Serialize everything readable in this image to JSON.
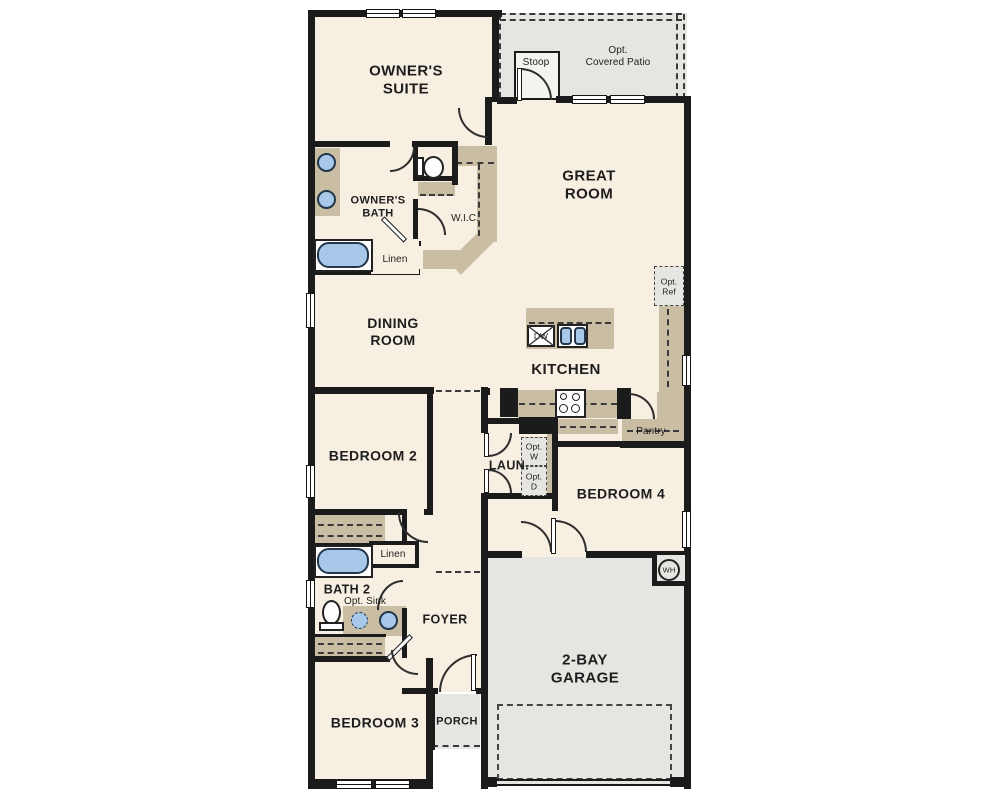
{
  "colors": {
    "floor": "#f6efe2",
    "wall": "#1b1b1b",
    "counter": "#c9bda3",
    "optional": "#e6e5e1",
    "fixture": "#a7c8e9",
    "label": "#1e1e1e"
  },
  "labels": {
    "owners_suite": "OWNER'S\nSUITE",
    "stoop": "Stoop",
    "covered_patio": "Opt.\nCovered Patio",
    "great_room": "GREAT\nROOM",
    "owners_bath": "OWNER'S\nBATH",
    "wic": "W.I.C.",
    "linen_owners": "Linen",
    "dining_room": "DINING\nROOM",
    "kitchen": "KITCHEN",
    "dishwasher": "DW",
    "opt_ref": "Opt.\nRef",
    "pantry": "Pantry",
    "bedroom2": "BEDROOM 2",
    "laundry": "LAUN.",
    "opt_washer": "Opt.\nW",
    "opt_dryer": "Opt.\nD",
    "bedroom4": "BEDROOM 4",
    "linen_hall": "Linen",
    "bath2": "BATH 2",
    "opt_sink": "Opt. Sink",
    "foyer": "FOYER",
    "water_heater": "WH",
    "garage": "2-BAY\nGARAGE",
    "bedroom3": "BEDROOM 3",
    "porch": "PORCH"
  }
}
